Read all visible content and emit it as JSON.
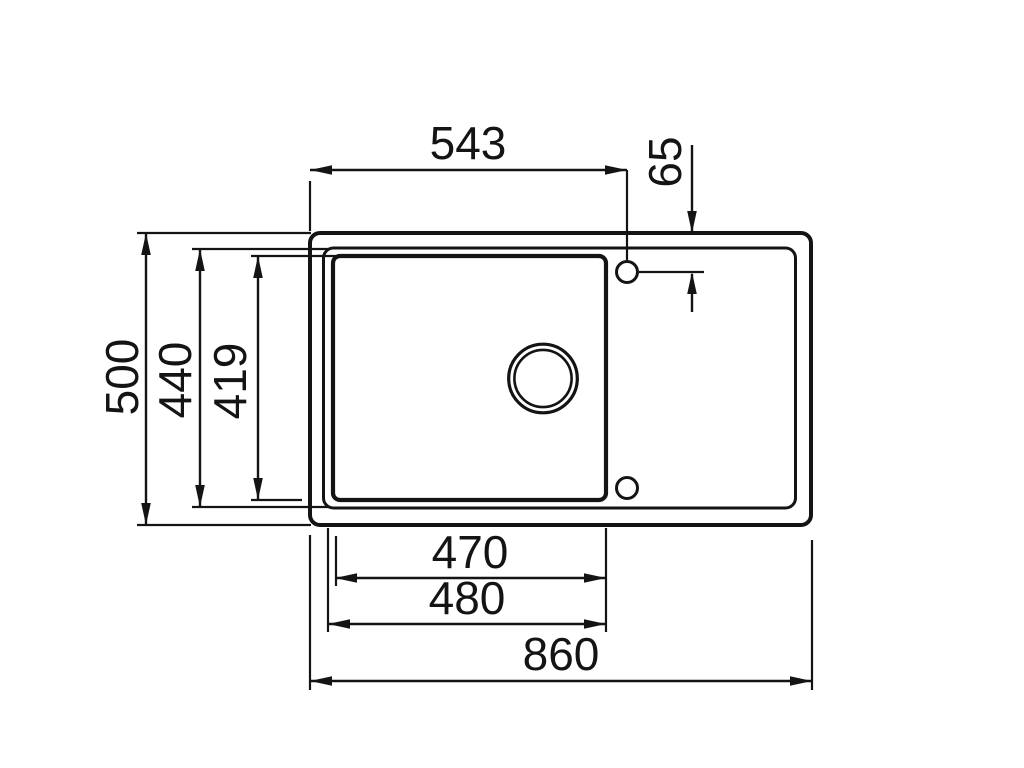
{
  "drawing": {
    "kind": "technical-dimension-drawing",
    "subject": "sink-with-drainboard-top-view",
    "background": "#ffffff",
    "line_color": "#141414",
    "dimensions": {
      "tap_holes_from_left": "543",
      "tap_hole_inset": "65",
      "overall_depth": "500",
      "rim_inner_depth": "440",
      "basin_depth": "419",
      "basin_width": "470",
      "basin_width_outer": "480",
      "overall_width": "860"
    }
  }
}
